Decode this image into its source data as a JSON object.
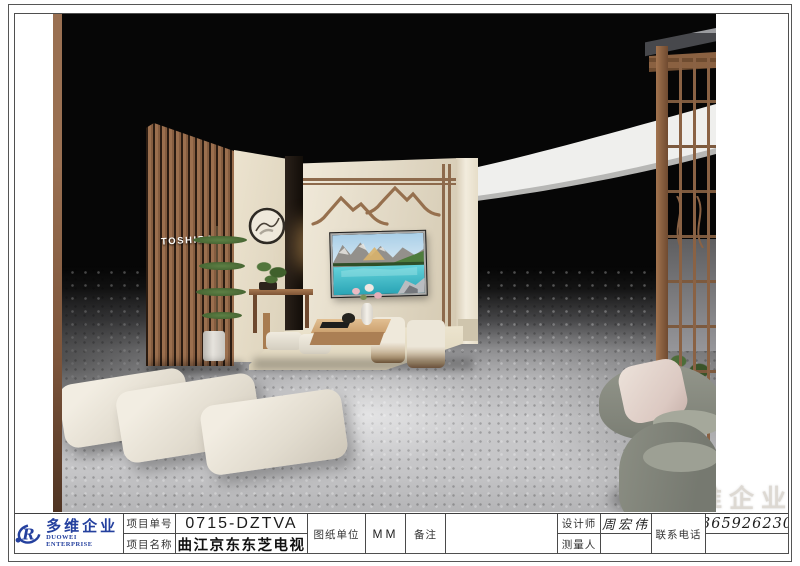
{
  "logo": {
    "zh": "多维企业",
    "en": "DUOWEI ENTERPRISE",
    "color": "#24409e"
  },
  "watermark": {
    "zh": "多维企业"
  },
  "render": {
    "toshiba_sign": "TOSHIBA"
  },
  "title_block": {
    "project_no": {
      "label": "项目单号",
      "value": "0715-DZTVA"
    },
    "project_name": {
      "label": "项目名称",
      "value": "曲江京东东芝电视"
    },
    "drawing_unit": {
      "label": "图纸单位",
      "value": "MM"
    },
    "remark": {
      "label": "备注",
      "value": ""
    },
    "designer": {
      "label": "设计师",
      "value": "周宏伟"
    },
    "surveyor": {
      "label": "测量人",
      "value": ""
    },
    "phone": {
      "label": "联系电话",
      "value": "13659262305"
    }
  },
  "colors": {
    "accent_blue": "#24409e",
    "wood_brown": "#9b6f4e",
    "cream_wall": "#ece4d2",
    "floor_gray": "#c6c6c8",
    "background_black": "#060606",
    "table_border": "#4a4a4a"
  }
}
